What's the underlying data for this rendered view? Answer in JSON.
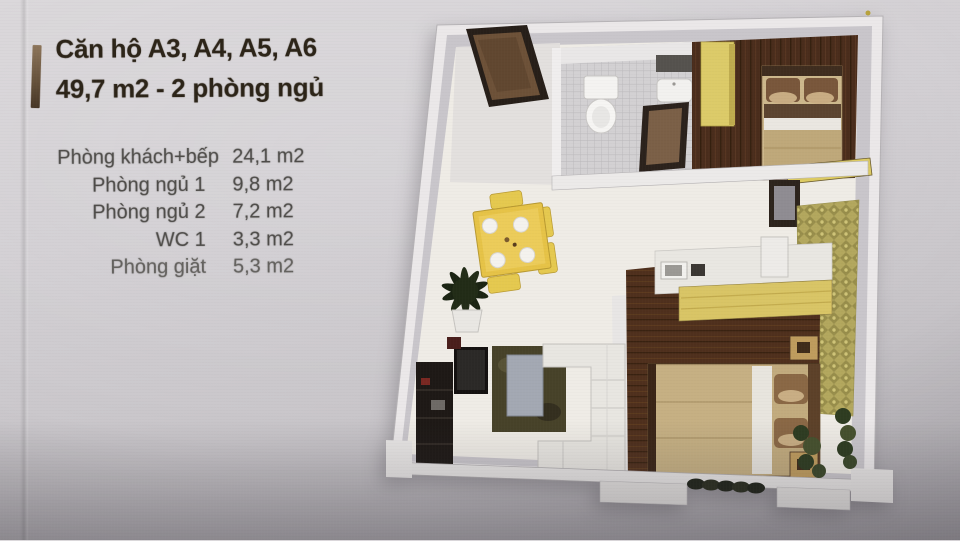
{
  "info_panel": {
    "title_line1": "Căn hộ A3, A4, A5, A6",
    "title_line2": "49,7 m2 - 2 phòng ngủ",
    "accent_bar_color": "#64503a",
    "title_color": "#2c2418",
    "table_text_color": "#4e4c49",
    "rooms": [
      {
        "label": "Phòng khách+bếp",
        "area": "24,1 m2"
      },
      {
        "label": "Phòng ngủ 1",
        "area": "9,8 m2"
      },
      {
        "label": "Phòng ngủ 2",
        "area": "7,2 m2"
      },
      {
        "label": "WC 1",
        "area": "3,3 m2"
      },
      {
        "label": "Phòng giặt",
        "area": "5,3 m2"
      }
    ]
  },
  "floor_plan": {
    "type": "3d-isometric-apartment-render",
    "rooms_depicted": [
      "living-kitchen",
      "bedroom-1",
      "bedroom-2",
      "bathroom",
      "laundry",
      "balcony"
    ],
    "colors": {
      "outer_wall": "#ebe8e9",
      "wall_face": "#c9c6cb",
      "floor_light": "#efece6",
      "floor_wood_dark": "#4a2d1c",
      "cabinet_yellow": "#dccb69",
      "counter_yellow": "#d9c566",
      "laundry_tile": "#b3a75e",
      "sofa_white": "#e8e6e1",
      "bed_blanket": "#c2ab7e",
      "pillow_brown": "#8a6845",
      "rug_dark": "#474229",
      "plant_green": "#232d18",
      "door_brown": "#6d5138"
    },
    "elements": [
      "entrance-door",
      "bathroom-toilet",
      "bathroom-sink",
      "bathroom-mirror",
      "bathroom-door",
      "wardrobe-bedroom-1",
      "bed-bedroom-1",
      "desk-shelf",
      "dresser-mirror",
      "laundry-floor-tiles",
      "kitchen-counter",
      "kitchen-sink",
      "stove",
      "fridge-box",
      "dining-table",
      "dining-plates",
      "dining-chairs",
      "potted-plant",
      "tv-cabinet",
      "tv",
      "rug",
      "coffee-table",
      "sofa",
      "bed-bedroom-2",
      "nightstands",
      "balcony-wall",
      "balcony-pillars",
      "shrubs",
      "corner-greenery"
    ]
  },
  "page": {
    "paper_color": "#d2cfd3"
  }
}
